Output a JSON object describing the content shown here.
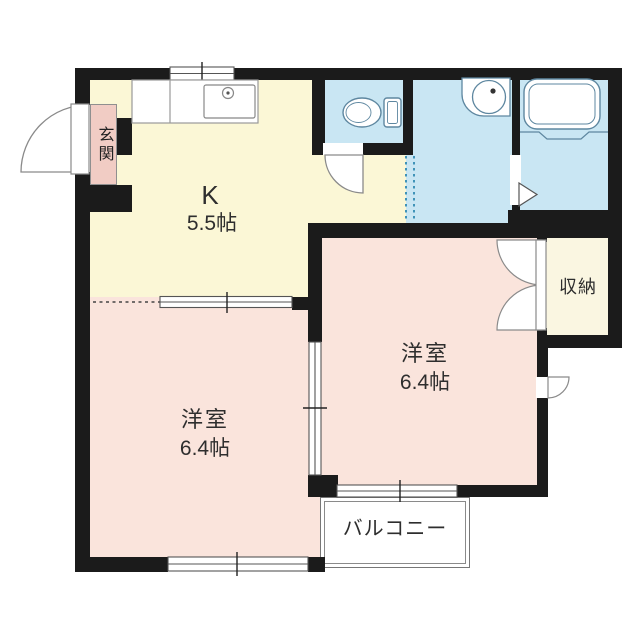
{
  "floorplan": {
    "rooms": {
      "kitchen": {
        "label": "K",
        "size": "5.5帖"
      },
      "bedroom_left": {
        "label": "洋室",
        "size": "6.4帖"
      },
      "bedroom_right": {
        "label": "洋室",
        "size": "6.4帖"
      },
      "entrance": {
        "label": "玄関"
      },
      "storage": {
        "label": "収納"
      },
      "balcony": {
        "label": "バルコニー"
      }
    },
    "colors": {
      "wall": "#1b1b1b",
      "kitchen_floor": "#fbf7d6",
      "bedroom_floor": "#fae4dc",
      "entrance_floor": "#f1ccc4",
      "water_area_floor": "#c9e6f3",
      "storage_floor": "#faf6e1",
      "fixture_outline": "#5e87a0"
    }
  }
}
